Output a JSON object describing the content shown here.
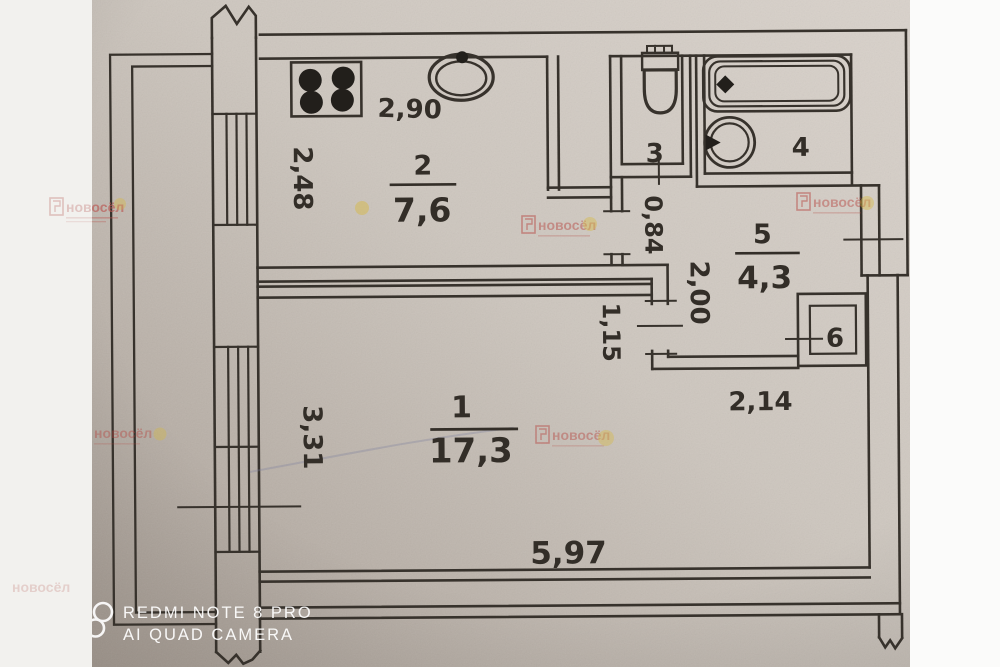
{
  "watermarks": {
    "agency": {
      "name": "новосёл"
    },
    "camera": {
      "line1": "REDMI NOTE 8 PRO",
      "line2": "AI QUAD CAMERA"
    }
  },
  "rooms": {
    "living": {
      "number": "1",
      "area": "17,3"
    },
    "kitchen": {
      "number": "2",
      "area": "7,6"
    },
    "wc": {
      "number": "3"
    },
    "bath": {
      "number": "4"
    },
    "hall": {
      "number": "5",
      "area": "4,3"
    },
    "closet": {
      "number": "6"
    }
  },
  "dimensions": {
    "kitchen_width": "2,90",
    "kitchen_depth": "2,48",
    "passage_width": "0,84",
    "hall_depth": "2,00",
    "wall_jog": "1,15",
    "living_depth": "3,31",
    "living_right_width": "2,14",
    "living_width": "5,97"
  },
  "fixtures": [
    "stove-icon",
    "sink-icon",
    "toilet-icon",
    "bathtub-icon",
    "washbasin-icon"
  ],
  "colors": {
    "paper": "#cdc6be",
    "ink": "#37322c",
    "agency_red": "#b5403a",
    "splash_yellow": "#d8b93e",
    "strip_left": "#f2f1ee",
    "strip_right": "#fbfbfa"
  }
}
